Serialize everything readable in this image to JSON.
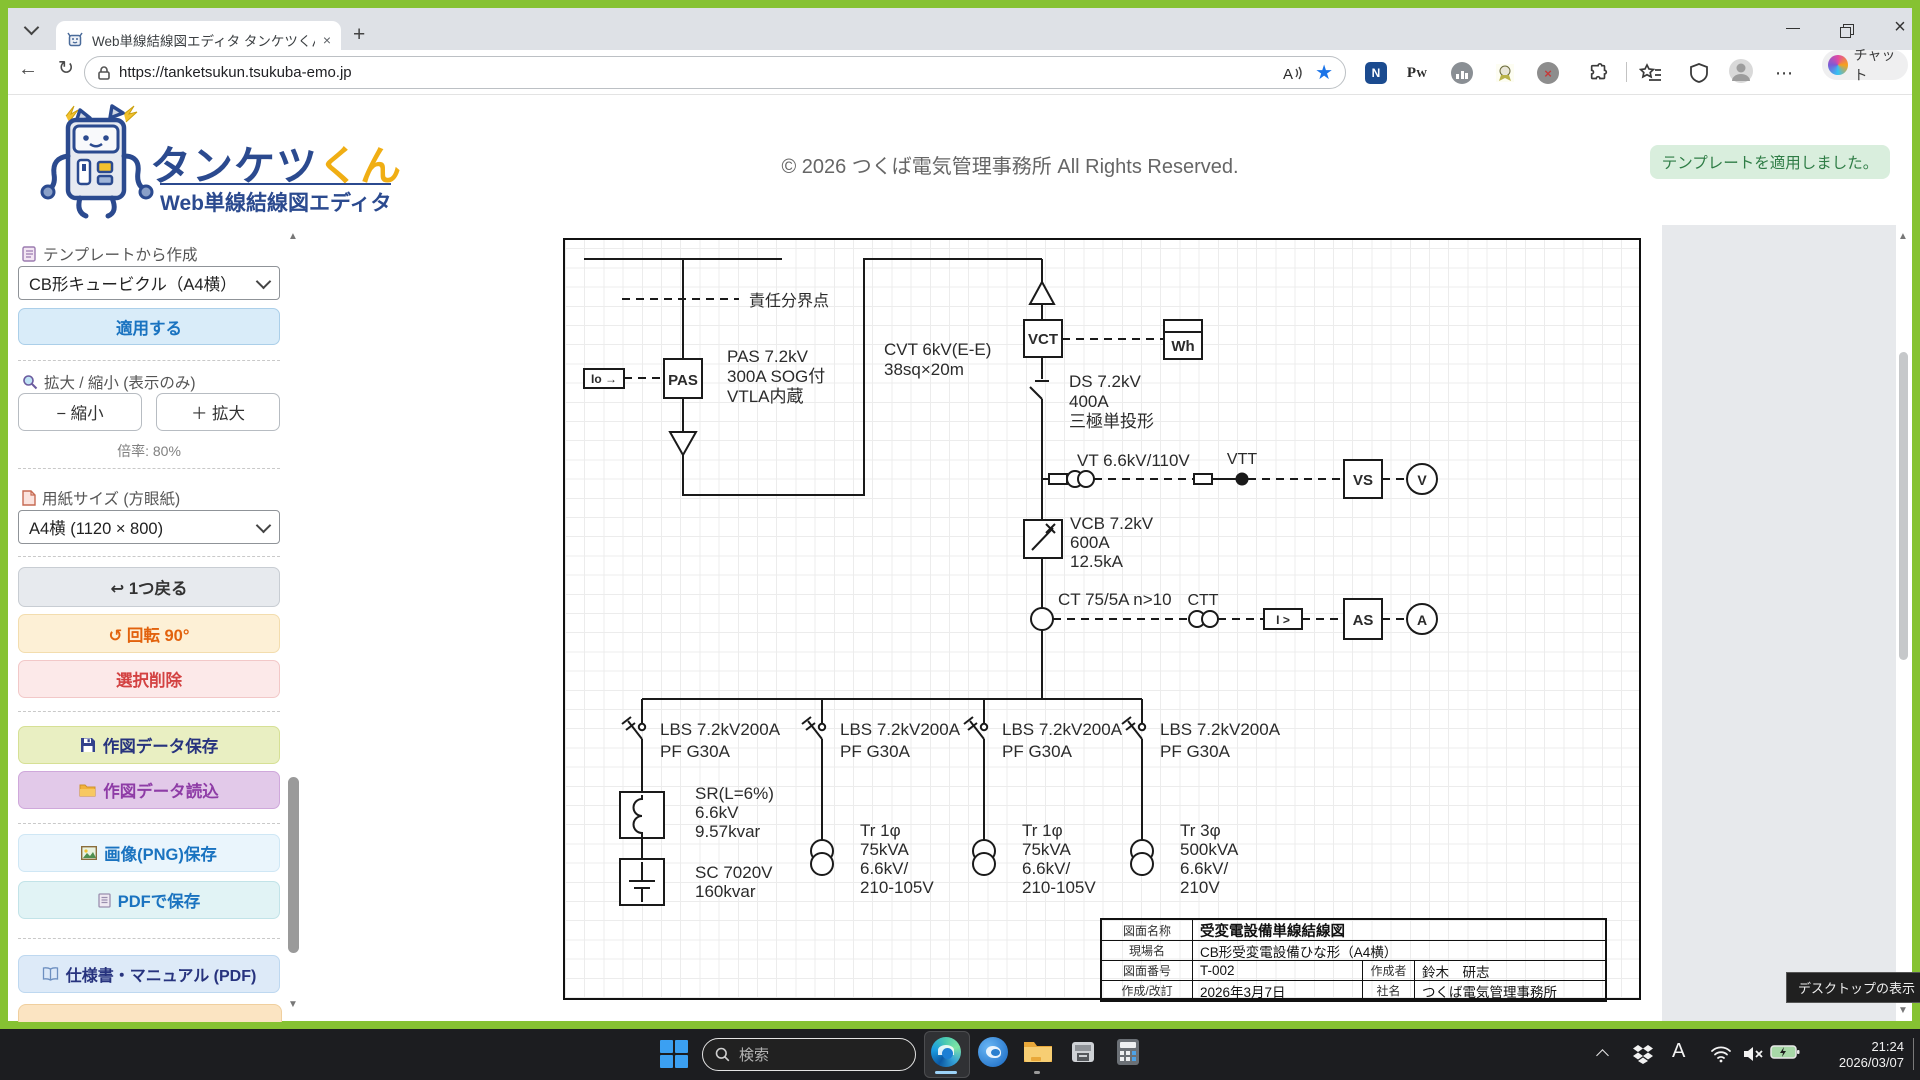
{
  "browser": {
    "tab_title": "Web単線結線図エディタ タンケツくん",
    "url": "https://tanketsukun.tsukuba-emo.jp",
    "copilot_label": "チャット"
  },
  "header": {
    "logo_title_main": "タンケツ",
    "logo_title_suffix": "くん",
    "logo_subtitle": "Web単線結線図エディタ",
    "copyright": "© 2026 つくば電気管理事務所 All Rights Reserved.",
    "toast": "テンプレートを適用しました。"
  },
  "sidebar": {
    "template_label": "テンプレートから作成",
    "template_select": "CB形キュービクル（A4横）",
    "apply_button": "適用する",
    "zoom_label": "拡大 / 縮小 (表示のみ)",
    "zoom_out": "− 縮小",
    "zoom_in": "＋ 拡大",
    "zoom_level": "倍率: 80%",
    "paper_label": "用紙サイズ (方眼紙)",
    "paper_select": "A4横 (1120 × 800)",
    "undo_button": "↩ 1つ戻る",
    "rotate_button": "↺ 回転 90°",
    "delete_button": "選択削除",
    "save_data_button": "作図データ保存",
    "load_data_button": "作図データ読込",
    "save_png_button": "画像(PNG)保存",
    "save_pdf_button": "PDFで保存",
    "manual_button": "仕様書・マニュアル (PDF)"
  },
  "diagram": {
    "boundary_label": "責任分界点",
    "io_label": "Io →",
    "pas_box": "PAS",
    "pas_spec": [
      "PAS 7.2kV",
      "300A SOG付",
      "VTLA内蔵"
    ],
    "cvt_spec": [
      "CVT 6kV(E-E)",
      "38sq×20m"
    ],
    "vct_box": "VCT",
    "wh_box": "Wh",
    "ds_spec": [
      "DS 7.2kV",
      "400A",
      "三極単投形"
    ],
    "vt_label": "VT 6.6kV/110V",
    "vtt_label": "VTT",
    "vs_box": "VS",
    "v_meter": "V",
    "vcb_spec": [
      "VCB 7.2kV",
      "600A",
      "12.5kA"
    ],
    "ct_label": "CT 75/5A n>10",
    "ctt_label": "CTT",
    "relay_box": "I >",
    "as_box": "AS",
    "a_meter": "A",
    "lbs_line1": "LBS 7.2kV200A",
    "lbs_line2": "PF G30A",
    "sr_spec": [
      "SR(L=6%)",
      "6.6kV",
      "9.57kvar"
    ],
    "sc_spec": [
      "SC 7020V",
      "160kvar"
    ],
    "tr1_spec": [
      "Tr 1φ",
      "75kVA",
      "6.6kV/",
      "210-105V"
    ],
    "tr3_spec": [
      "Tr 3φ",
      "500kVA",
      "6.6kV/",
      "210V"
    ],
    "titleblock": {
      "r1l": "図面名称",
      "r1v": "受変電設備単線結線図",
      "r2l": "現場名",
      "r2v": "CB形受変電設備ひな形（A4横）",
      "r3l": "図面番号",
      "r3v": "T-002",
      "r3l2": "作成者",
      "r3v2": "鈴木　研志",
      "r4l": "作成/改訂",
      "r4v": "2026年3月7日",
      "r4l2": "社名",
      "r4v2": "つくば電気管理事務所"
    }
  },
  "taskbar": {
    "search_placeholder": "検索",
    "ime_mode": "A",
    "time": "21:24",
    "date": "2026/03/07",
    "tooltip": "デスクトップの表示"
  }
}
